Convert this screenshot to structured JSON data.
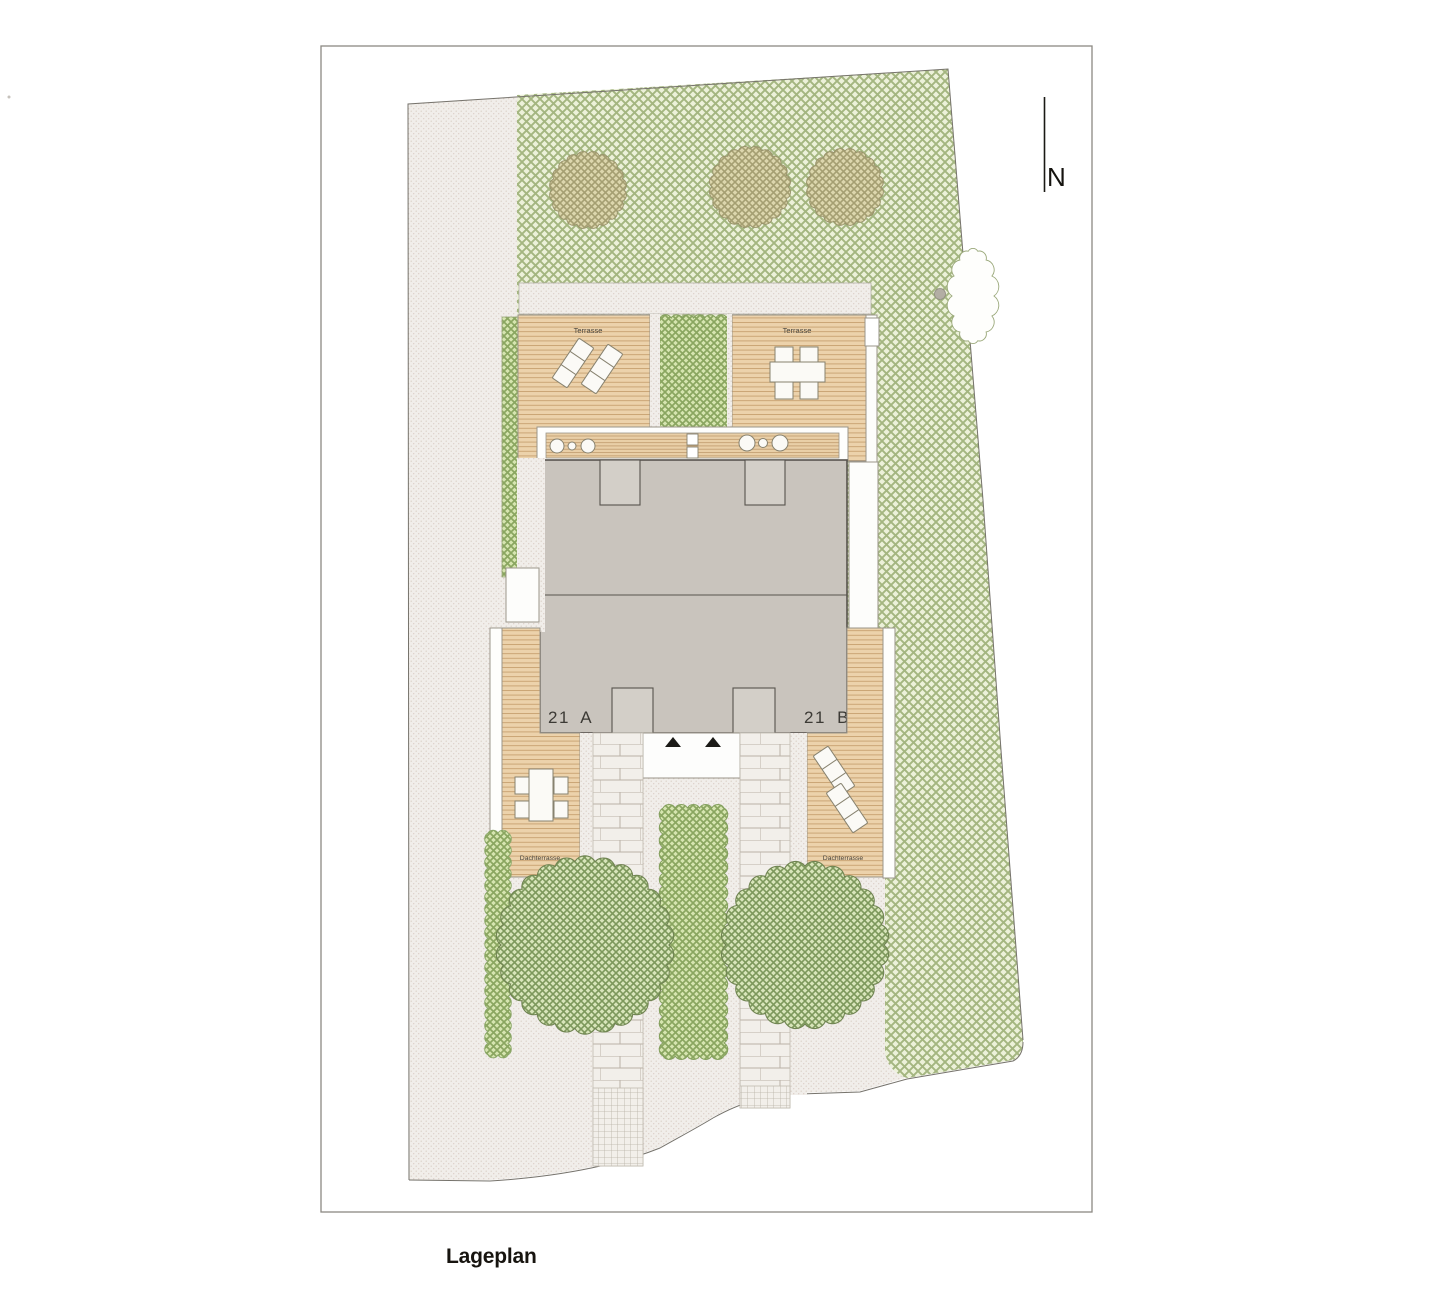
{
  "title": "Lageplan",
  "compass": {
    "label": "N"
  },
  "units": {
    "left": "21 A",
    "right": "21 B"
  },
  "labels": {
    "terrace_left": "Terrasse",
    "terrace_right": "Terrasse",
    "roof_terrace_left": "Dachterrasse",
    "roof_terrace_right": "Dachterrasse"
  },
  "colors": {
    "lawn_bg": "#ecf1d9",
    "lawn_line": "#a4b680",
    "tree_bg": "#d8e5ba",
    "tree_line": "#7d985c",
    "olive_tree_bg": "#dcd6ad",
    "olive_tree_line": "#a59f72",
    "hedge_bg": "#d6e5b0",
    "hedge_line": "#8aa660",
    "wood_bg": "#ecd2ab",
    "wood_line": "#c7a06f",
    "building_fill": "#c9c4bd",
    "building_notch_fill": "#d3cfc8",
    "building_outline": "#57534d",
    "paving_bg": "#f1eeea",
    "paving_dot": "#dbd1c8",
    "boundary_line": "#76736c",
    "stone_fill": "#b3aea4"
  }
}
